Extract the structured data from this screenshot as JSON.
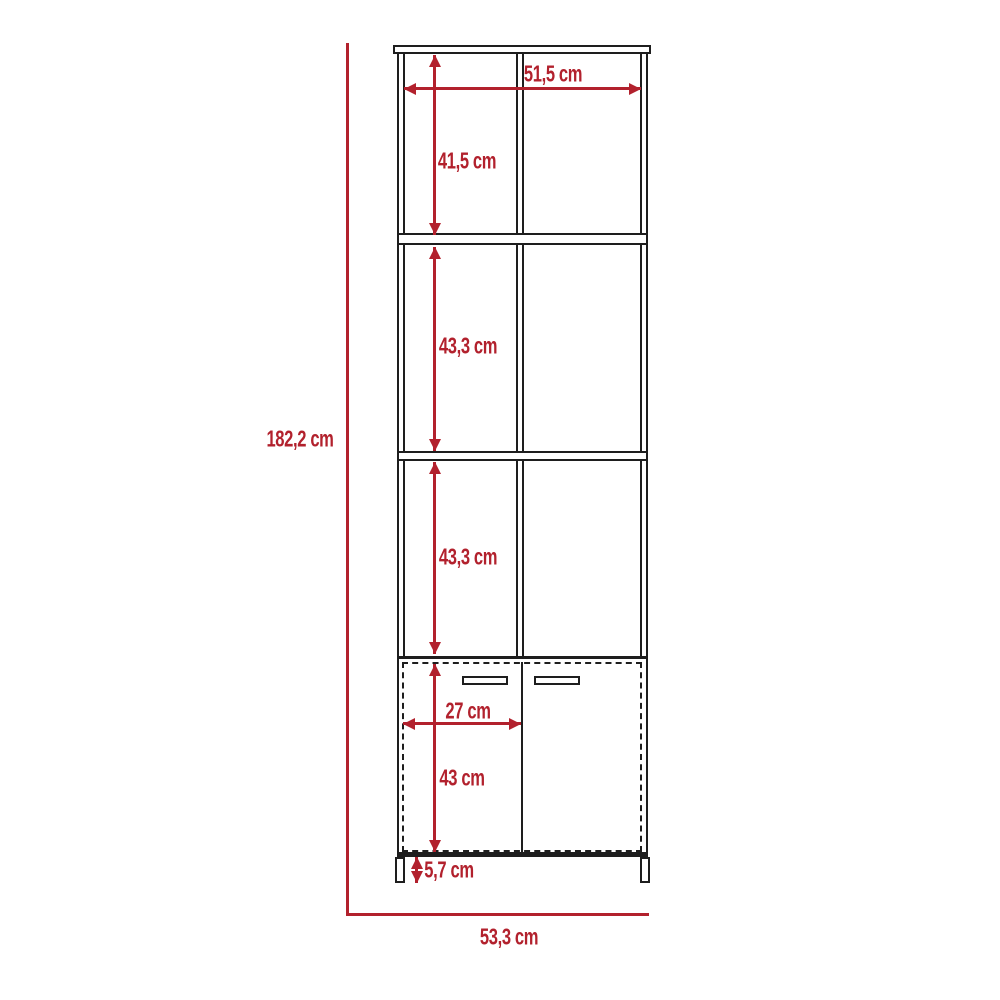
{
  "diagram": {
    "kind": "furniture-dimension-drawing",
    "subject": "tall open shelving unit with two-door base cabinet on legs",
    "colors": {
      "dimension_red": "#b2212d",
      "line_dark": "#1e1e1e",
      "background": "#ffffff"
    },
    "dimensions": {
      "overall_height": "182,2 cm",
      "overall_width": "53,3 cm",
      "inner_width": "51,5 cm",
      "top_compartment_height": "41,5 cm",
      "second_compartment_height": "43,3 cm",
      "third_compartment_height": "43,3 cm",
      "door_width": "27 cm",
      "door_height": "43 cm",
      "leg_height": "5,7 cm"
    }
  }
}
